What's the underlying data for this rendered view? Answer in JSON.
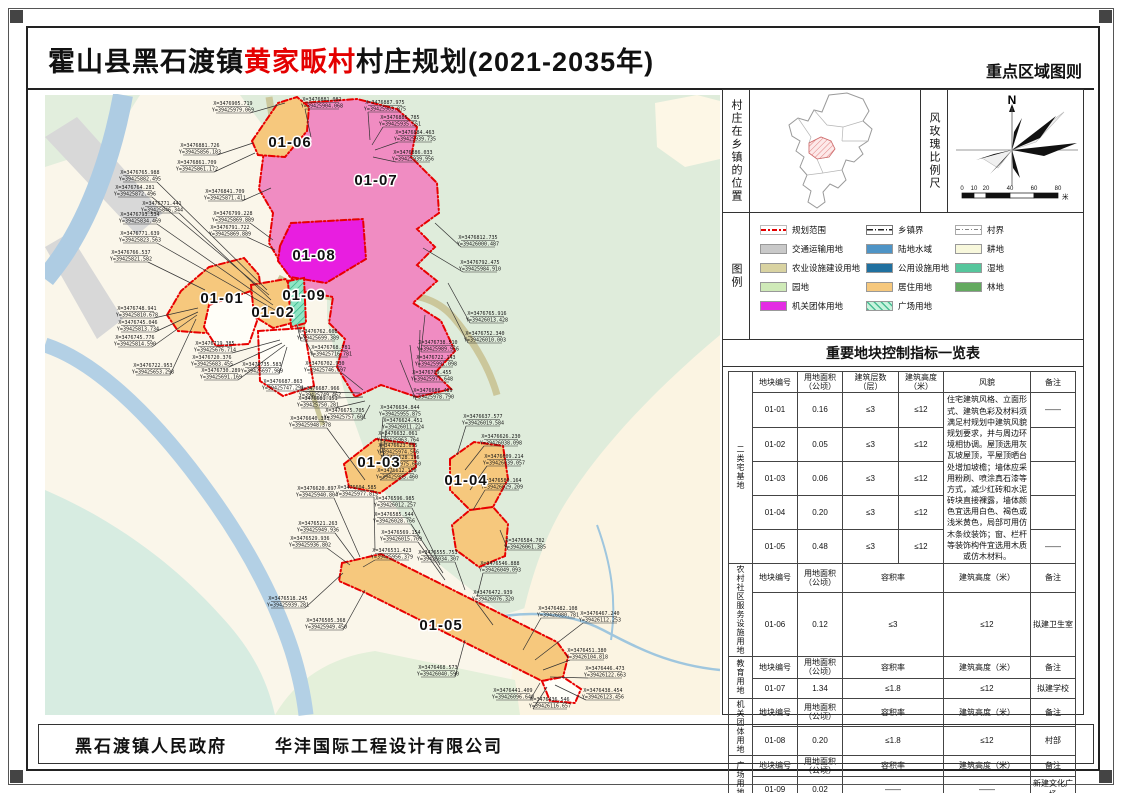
{
  "header": {
    "title_prefix": "霍山县黑石渡镇",
    "title_highlight": "黄家畈村",
    "title_suffix": "村庄规划(2021-2035年)",
    "sheet_type": "重点区域图则"
  },
  "footer": {
    "government": "黑石渡镇人民政府",
    "design_company": "华沣国际工程设计有限公司"
  },
  "side_panel": {
    "location_label": "村庄在乡镇的位置",
    "windrose_label": "风玫瑰比例尺",
    "windrose": {
      "north": "N",
      "scale_ticks": [
        "0",
        "10",
        "20",
        "40",
        "60",
        "80"
      ],
      "scale_unit": "米"
    },
    "legend_label": "图例",
    "legend_columns": [
      [
        {
          "label": "规划范围",
          "swatch": "line-red",
          "color": "#e40000"
        },
        {
          "label": "交通运输用地",
          "swatch": "fill",
          "color": "#c9c9c9"
        },
        {
          "label": "农业设施建设用地",
          "swatch": "fill",
          "color": "#d9d3a2"
        },
        {
          "label": "园地",
          "swatch": "fill",
          "color": "#cfeab8"
        },
        {
          "label": "机关团体用地",
          "swatch": "fill",
          "color": "#e32ce3"
        }
      ],
      [
        {
          "label": "乡镇界",
          "swatch": "line-town",
          "color": "#222222"
        },
        {
          "label": "陆地水域",
          "swatch": "fill",
          "color": "#4e94c6"
        },
        {
          "label": "公用设施用地",
          "swatch": "fill",
          "color": "#20709f"
        },
        {
          "label": "居住用地",
          "swatch": "fill",
          "color": "#f6c87d"
        },
        {
          "label": "广场用地",
          "swatch": "hatch",
          "color": "#c8f3dd"
        }
      ],
      [
        {
          "label": "村界",
          "swatch": "line-village",
          "color": "#888888"
        },
        {
          "label": "耕地",
          "swatch": "fill",
          "color": "#f8f8dc"
        },
        {
          "label": "湿地",
          "swatch": "fill",
          "color": "#56c69c"
        },
        {
          "label": "林地",
          "swatch": "fill",
          "color": "#63a95f"
        }
      ]
    ],
    "table": {
      "title": "重要地块控制指标一览表",
      "sections": [
        {
          "group": "二类宅基地",
          "headers": [
            "地块编号",
            "用地面积（公顷）",
            "建筑层数（层）",
            "建筑高度（米）",
            "风貌",
            "备注"
          ],
          "rows": [
            {
              "id": "01-01",
              "area": "0.16",
              "floors": "≤3",
              "height": "≤12",
              "note": "——"
            },
            {
              "id": "01-02",
              "area": "0.05",
              "floors": "≤3",
              "height": "≤12",
              "note": ""
            },
            {
              "id": "01-03",
              "area": "0.06",
              "floors": "≤3",
              "height": "≤12",
              "note": ""
            },
            {
              "id": "01-04",
              "area": "0.20",
              "floors": "≤3",
              "height": "≤12",
              "note": ""
            },
            {
              "id": "01-05",
              "area": "0.48",
              "floors": "≤3",
              "height": "≤12",
              "note": "——"
            }
          ],
          "style_guideline": "住宅建筑风格、立面形式、建筑色彩及材料须满足村规划中建筑风貌规划要求，并与周边环境相协调。屋顶选用灰瓦坡屋顶，平屋顶晒台处增加坡檐；墙体应采用粉刷、喷涂真石漆等方式，减少红砖和水泥砖块直接裸露，墙体颜色宜选用白色、褐色或浅米黄色，局部可用仿木条纹装饰；窗、栏杆等装饰构件宜选用木质或仿木材料。"
        },
        {
          "group": "农村社区服务设施用地",
          "headers": [
            "地块编号",
            "用地面积（公顷）",
            "容积率",
            "建筑高度（米）",
            "备注"
          ],
          "rows": [
            {
              "id": "01-06",
              "area": "0.12",
              "far": "≤3",
              "height": "≤12",
              "note": "拟建卫生室"
            }
          ]
        },
        {
          "group": "教育用地",
          "headers": [
            "地块编号",
            "用地面积（公顷）",
            "容积率",
            "建筑高度（米）",
            "备注"
          ],
          "rows": [
            {
              "id": "01-07",
              "area": "1.34",
              "far": "≤1.8",
              "height": "≤12",
              "note": "拟建学校"
            }
          ]
        },
        {
          "group": "机关团体用地",
          "headers": [
            "地块编号",
            "用地面积（公顷）",
            "容积率",
            "建筑高度（米）",
            "备注"
          ],
          "rows": [
            {
              "id": "01-08",
              "area": "0.20",
              "far": "≤1.8",
              "height": "≤12",
              "note": "村部"
            }
          ]
        },
        {
          "group": "广场用地",
          "headers": [
            "地块编号",
            "用地面积（公顷）",
            "容积率",
            "建筑高度（米）",
            "备注"
          ],
          "rows": [
            {
              "id": "01-09",
              "area": "0.02",
              "far": "——",
              "height": "——",
              "note": "新建文化广场"
            }
          ]
        }
      ]
    }
  },
  "map": {
    "parcels": [
      {
        "id": "01-01",
        "x": 177,
        "y": 208,
        "color": "#f6c87d"
      },
      {
        "id": "01-02",
        "x": 228,
        "y": 222,
        "color": "#f6c87d"
      },
      {
        "id": "01-03",
        "x": 334,
        "y": 372,
        "color": "#f6c87d"
      },
      {
        "id": "01-04",
        "x": 421,
        "y": 390,
        "color": "#f6c87d"
      },
      {
        "id": "01-05",
        "x": 396,
        "y": 535,
        "color": "#f6c87d"
      },
      {
        "id": "01-06",
        "x": 245,
        "y": 52,
        "color": "#f6c87d"
      },
      {
        "id": "01-07",
        "x": 331,
        "y": 90,
        "color": "#f08cc2"
      },
      {
        "id": "01-08",
        "x": 269,
        "y": 165,
        "color": "#e81ee0"
      },
      {
        "id": "01-09",
        "x": 259,
        "y": 205,
        "color": "#8ee6c4"
      }
    ],
    "coords": [
      {
        "x": 188,
        "y": 10,
        "tx": 240,
        "ty": 8,
        "X": "X=3476905.719",
        "Y": "Y=39425979.069"
      },
      {
        "x": 155,
        "y": 52,
        "tx": 208,
        "ty": 48,
        "X": "X=3476881.726",
        "Y": "Y=39425856.183"
      },
      {
        "x": 152,
        "y": 69,
        "tx": 210,
        "ty": 58,
        "X": "X=3476861.709",
        "Y": "Y=39425861.172"
      },
      {
        "x": 95,
        "y": 79,
        "tx": 222,
        "ty": 195,
        "X": "X=3476765.988",
        "Y": "Y=39425882.495"
      },
      {
        "x": 90,
        "y": 94,
        "tx": 224,
        "ty": 200,
        "X": "X=3476764.281",
        "Y": "Y=39425872.496"
      },
      {
        "x": 117,
        "y": 110,
        "tx": 226,
        "ty": 205,
        "X": "X=3476771.441",
        "Y": "Y=39425846.344"
      },
      {
        "x": 95,
        "y": 121,
        "tx": 228,
        "ty": 210,
        "X": "X=3476793.534",
        "Y": "Y=39425834.469"
      },
      {
        "x": 95,
        "y": 140,
        "tx": 230,
        "ty": 215,
        "X": "X=3476771.639",
        "Y": "Y=39425823.563"
      },
      {
        "x": 86,
        "y": 159,
        "tx": 160,
        "ty": 195,
        "X": "X=3476766.537",
        "Y": "Y=39425821.582"
      },
      {
        "x": 180,
        "y": 98,
        "tx": 226,
        "ty": 93,
        "X": "X=3476841.709",
        "Y": "Y=39425871.411"
      },
      {
        "x": 188,
        "y": 120,
        "tx": 228,
        "ty": 145,
        "X": "X=3476799.228",
        "Y": "Y=39425869.889"
      },
      {
        "x": 185,
        "y": 134,
        "tx": 230,
        "ty": 155,
        "X": "X=3476791.722",
        "Y": "Y=39425869.889"
      },
      {
        "x": 277,
        "y": 6,
        "tx": 266,
        "ty": 42,
        "X": "X=3476881.082",
        "Y": "Y=39425904.068"
      },
      {
        "x": 340,
        "y": 9,
        "tx": 325,
        "ty": 45,
        "X": "X=3476887.975",
        "Y": "Y=39425903.875"
      },
      {
        "x": 355,
        "y": 24,
        "tx": 327,
        "ty": 50,
        "X": "X=3476885.785",
        "Y": "Y=39425935.551"
      },
      {
        "x": 370,
        "y": 39,
        "tx": 330,
        "ty": 55,
        "X": "X=3476884.463",
        "Y": "Y=39425939.735"
      },
      {
        "x": 368,
        "y": 59,
        "tx": 328,
        "ty": 62,
        "X": "X=3476886.033",
        "Y": "Y=39425939.956"
      },
      {
        "x": 433,
        "y": 144,
        "tx": 390,
        "ty": 128,
        "X": "X=3476812.735",
        "Y": "Y=39426000.487"
      },
      {
        "x": 435,
        "y": 169,
        "tx": 378,
        "ty": 153,
        "X": "X=3476792.475",
        "Y": "Y=39425984.910"
      },
      {
        "x": 442,
        "y": 220,
        "tx": 403,
        "ty": 188,
        "X": "X=3476765.916",
        "Y": "Y=39426013.428"
      },
      {
        "x": 440,
        "y": 240,
        "tx": 402,
        "ty": 207,
        "X": "X=3476752.340",
        "Y": "Y=39426010.003"
      },
      {
        "x": 393,
        "y": 249,
        "tx": 380,
        "ty": 220,
        "X": "X=3476738.510",
        "Y": "Y=39425989.956"
      },
      {
        "x": 391,
        "y": 264,
        "tx": 375,
        "ty": 235,
        "X": "X=3476722.143",
        "Y": "Y=39425991.098"
      },
      {
        "x": 387,
        "y": 279,
        "tx": 365,
        "ty": 250,
        "X": "X=3476709.455",
        "Y": "Y=39425977.648"
      },
      {
        "x": 388,
        "y": 297,
        "tx": 355,
        "ty": 265,
        "X": "X=3476686.489",
        "Y": "Y=39425978.790"
      },
      {
        "x": 92,
        "y": 215,
        "tx": 153,
        "ty": 213,
        "X": "X=3476748.941",
        "Y": "Y=39425810.678"
      },
      {
        "x": 93,
        "y": 229,
        "tx": 153,
        "ty": 217,
        "X": "X=3476745.046",
        "Y": "Y=39425813.734"
      },
      {
        "x": 90,
        "y": 244,
        "tx": 152,
        "ty": 220,
        "X": "X=3476745.776",
        "Y": "Y=39425814.590"
      },
      {
        "x": 108,
        "y": 272,
        "tx": 151,
        "ty": 224,
        "X": "X=3476722.953",
        "Y": "Y=39425653.298"
      },
      {
        "x": 170,
        "y": 250,
        "tx": 235,
        "ty": 245,
        "X": "X=3476719.385",
        "Y": "Y=39425676.714"
      },
      {
        "x": 167,
        "y": 264,
        "tx": 237,
        "ty": 248,
        "X": "X=3476720.376",
        "Y": "Y=39425683.455"
      },
      {
        "x": 176,
        "y": 277,
        "tx": 240,
        "ty": 250,
        "X": "X=3476730.289",
        "Y": "Y=39425691.169"
      },
      {
        "x": 217,
        "y": 271,
        "tx": 242,
        "ty": 252,
        "X": "X=3476735.583",
        "Y": "Y=39425697.989"
      },
      {
        "x": 273,
        "y": 238,
        "tx": 252,
        "ty": 230,
        "X": "X=3476762.608",
        "Y": "Y=39425699.389"
      },
      {
        "x": 286,
        "y": 254,
        "tx": 258,
        "ty": 240,
        "X": "X=3476768.781",
        "Y": "Y=39425716.781"
      },
      {
        "x": 280,
        "y": 270,
        "tx": 318,
        "ty": 295,
        "X": "X=3476702.930",
        "Y": "Y=39425746.697"
      },
      {
        "x": 238,
        "y": 288,
        "tx": 315,
        "ty": 298,
        "X": "X=3476687.863",
        "Y": "Y=39425747.291"
      },
      {
        "x": 275,
        "y": 295,
        "tx": 318,
        "ty": 302,
        "X": "X=3476687.966",
        "Y": "Y=39425749.462"
      },
      {
        "x": 273,
        "y": 305,
        "tx": 320,
        "ty": 306,
        "X": "X=3476681.151",
        "Y": "Y=39425750.281"
      },
      {
        "x": 300,
        "y": 317,
        "tx": 325,
        "ty": 310,
        "X": "X=3476675.705",
        "Y": "Y=39425757.601"
      },
      {
        "x": 265,
        "y": 325,
        "tx": 320,
        "ty": 385,
        "X": "X=3476640.395",
        "Y": "Y=39425948.378"
      },
      {
        "x": 355,
        "y": 314,
        "tx": 335,
        "ty": 360,
        "X": "X=3476634.844",
        "Y": "Y=39425955.875"
      },
      {
        "x": 358,
        "y": 327,
        "tx": 338,
        "ty": 363,
        "X": "X=3476624.451",
        "Y": "Y=39426011.224"
      },
      {
        "x": 353,
        "y": 340,
        "tx": 340,
        "ty": 366,
        "X": "X=3476632.061",
        "Y": "Y=39425963.764"
      },
      {
        "x": 353,
        "y": 352,
        "tx": 342,
        "ty": 370,
        "X": "X=3476623.695",
        "Y": "Y=39425974.566"
      },
      {
        "x": 355,
        "y": 364,
        "tx": 345,
        "ty": 373,
        "X": "X=3476628.196",
        "Y": "Y=39425975.660"
      },
      {
        "x": 352,
        "y": 377,
        "tx": 348,
        "ty": 376,
        "X": "X=3476612.150",
        "Y": "Y=39425985.460"
      },
      {
        "x": 438,
        "y": 323,
        "tx": 412,
        "ty": 360,
        "X": "X=3476637.577",
        "Y": "Y=39426019.584"
      },
      {
        "x": 456,
        "y": 343,
        "tx": 420,
        "ty": 375,
        "X": "X=3476626.230",
        "Y": "Y=39426038.098"
      },
      {
        "x": 459,
        "y": 363,
        "tx": 425,
        "ty": 395,
        "X": "X=3476609.214",
        "Y": "Y=39426039.057"
      },
      {
        "x": 457,
        "y": 387,
        "tx": 428,
        "ty": 415,
        "X": "X=3476589.164",
        "Y": "Y=39426029.209"
      },
      {
        "x": 480,
        "y": 447,
        "tx": 455,
        "ty": 435,
        "X": "X=3476584.702",
        "Y": "Y=39426061.385"
      },
      {
        "x": 272,
        "y": 395,
        "tx": 315,
        "ty": 462,
        "X": "X=3476620.897",
        "Y": "Y=39425940.804"
      },
      {
        "x": 312,
        "y": 394,
        "tx": 330,
        "ty": 455,
        "X": "X=3476604.585",
        "Y": "Y=39425977.819"
      },
      {
        "x": 350,
        "y": 405,
        "tx": 395,
        "ty": 470,
        "X": "X=3476596.985",
        "Y": "Y=39426012.257"
      },
      {
        "x": 349,
        "y": 421,
        "tx": 398,
        "ty": 478,
        "X": "X=3476585.544",
        "Y": "Y=39426028.766"
      },
      {
        "x": 356,
        "y": 439,
        "tx": 400,
        "ty": 485,
        "X": "X=3476569.154",
        "Y": "Y=39426015.709"
      },
      {
        "x": 393,
        "y": 459,
        "tx": 420,
        "ty": 495,
        "X": "X=3476555.753",
        "Y": "Y=39426034.307"
      },
      {
        "x": 455,
        "y": 470,
        "tx": 432,
        "ty": 502,
        "X": "X=3476546.888",
        "Y": "Y=39426049.093"
      },
      {
        "x": 273,
        "y": 430,
        "tx": 310,
        "ty": 465,
        "X": "X=3476521.263",
        "Y": "Y=39425949.936"
      },
      {
        "x": 265,
        "y": 445,
        "tx": 305,
        "ty": 470,
        "X": "X=3476529.936",
        "Y": "Y=39425936.802"
      },
      {
        "x": 347,
        "y": 457,
        "tx": 318,
        "ty": 472,
        "X": "X=3476531.423",
        "Y": "Y=39425956.379"
      },
      {
        "x": 243,
        "y": 505,
        "tx": 298,
        "ty": 478,
        "X": "X=3476518.245",
        "Y": "Y=39425939.281"
      },
      {
        "x": 281,
        "y": 527,
        "tx": 320,
        "ty": 495,
        "X": "X=3476505.368",
        "Y": "Y=39425949.450"
      },
      {
        "x": 448,
        "y": 499,
        "tx": 448,
        "ty": 530,
        "X": "X=3476472.939",
        "Y": "Y=39426076.320"
      },
      {
        "x": 393,
        "y": 574,
        "tx": 420,
        "ty": 545,
        "X": "X=3476468.573",
        "Y": "Y=39426040.590"
      },
      {
        "x": 513,
        "y": 515,
        "tx": 478,
        "ty": 555,
        "X": "X=3476482.108",
        "Y": "Y=39426080.781"
      },
      {
        "x": 555,
        "y": 520,
        "tx": 490,
        "ty": 565,
        "X": "X=3476467.240",
        "Y": "Y=39426112.253"
      },
      {
        "x": 542,
        "y": 557,
        "tx": 498,
        "ty": 575,
        "X": "X=3476451.380",
        "Y": "Y=39426104.818"
      },
      {
        "x": 560,
        "y": 575,
        "tx": 505,
        "ty": 582,
        "X": "X=3476446.473",
        "Y": "Y=39426122.663"
      },
      {
        "x": 558,
        "y": 597,
        "tx": 510,
        "ty": 590,
        "X": "X=3476438.454",
        "Y": "Y=39426123.456"
      },
      {
        "x": 468,
        "y": 597,
        "tx": 495,
        "ty": 588,
        "X": "X=3476441.409",
        "Y": "Y=39426096.640"
      },
      {
        "x": 505,
        "y": 606,
        "tx": 502,
        "ty": 592,
        "X": "X=3476436.546",
        "Y": "Y=39426116.657"
      }
    ]
  }
}
